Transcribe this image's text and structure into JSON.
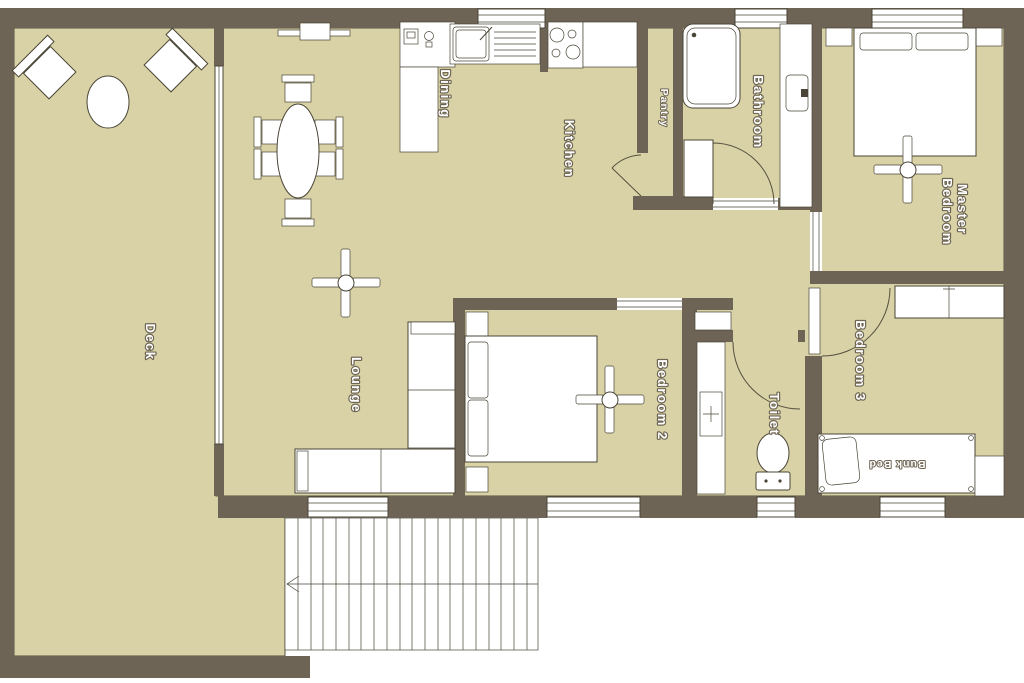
{
  "plan": {
    "type": "floor-plan",
    "colors": {
      "wall": "#6e6455",
      "floor": "#d8d2a6",
      "fixture": "#ffffff",
      "outline": "#4a4537",
      "background": "#ffffff",
      "label_fill": "#ffffff",
      "label_stroke": "#6f6654"
    },
    "rooms": [
      {
        "id": "deck",
        "label": "Deck"
      },
      {
        "id": "lounge",
        "label": "Lounge"
      },
      {
        "id": "dining",
        "label": "Dining"
      },
      {
        "id": "kitchen",
        "label": "Kitchen"
      },
      {
        "id": "pantry",
        "label": "Pantry"
      },
      {
        "id": "bathroom",
        "label": "Bathroom"
      },
      {
        "id": "master-bedroom",
        "label": "Master Bedroom",
        "line1": "Master",
        "line2": "Bedroom"
      },
      {
        "id": "bedroom-2",
        "label": "Bedroom 2"
      },
      {
        "id": "bedroom-3",
        "label": "Bedroom 3"
      },
      {
        "id": "toilet",
        "label": "Toilet"
      },
      {
        "id": "bunk-bed",
        "label": "Bunk Bed"
      }
    ]
  }
}
